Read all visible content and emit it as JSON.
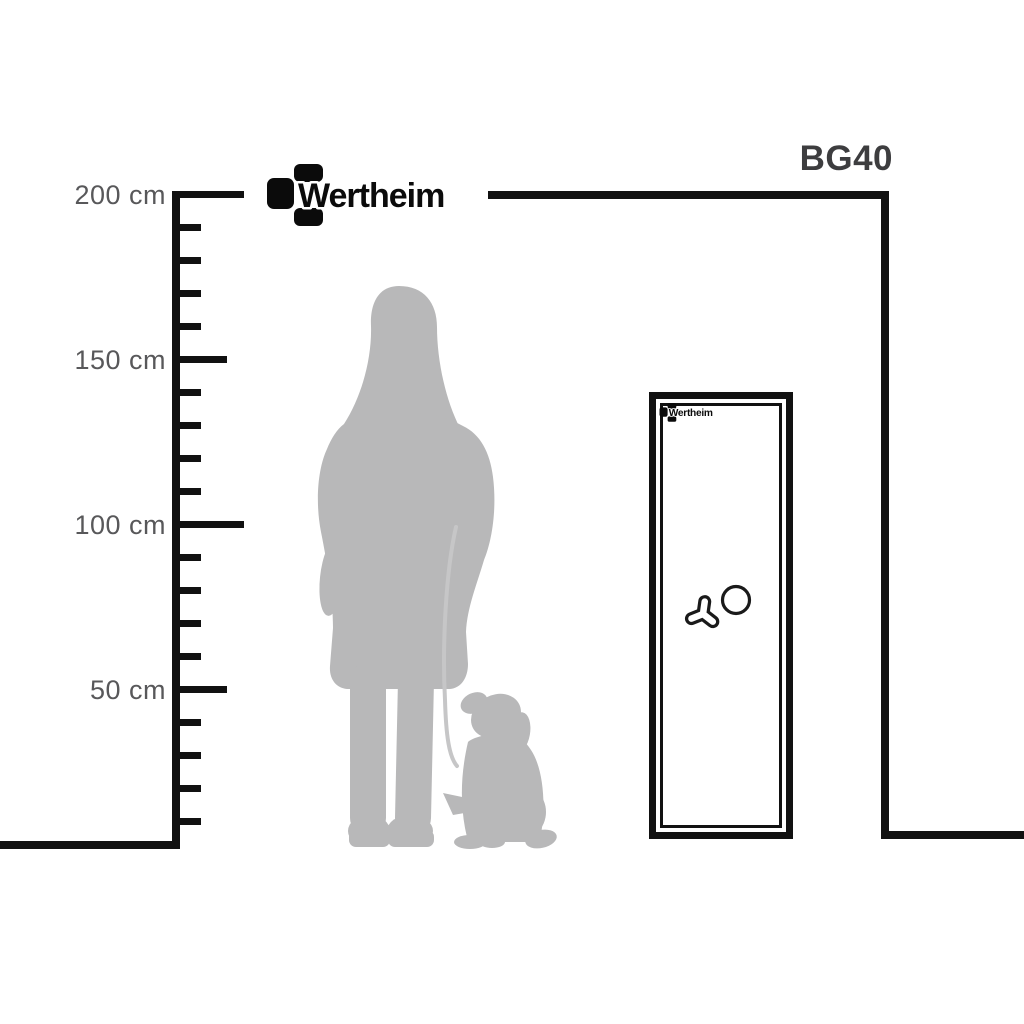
{
  "brand_logo": {
    "text": "Wertheim"
  },
  "product": {
    "model": "BG40"
  },
  "ruler": {
    "labels": [
      {
        "text": "200 cm"
      },
      {
        "text": "150 cm"
      },
      {
        "text": "100 cm"
      },
      {
        "text": "50 cm"
      }
    ]
  },
  "safe": {
    "logo_text": "Wertheim"
  },
  "icons": {
    "logo_mark": "wertheim-block-mark",
    "knob": "tri-spoke-handle",
    "dial": "round-dial",
    "figure": "woman-with-dog-silhouette"
  },
  "colors": {
    "line": "#111111",
    "label": "#58585a",
    "model": "#3d3d3f",
    "logo": "#0b0b0b",
    "silhouette": "#b8b8b9",
    "leash": "#c6c6c7"
  }
}
